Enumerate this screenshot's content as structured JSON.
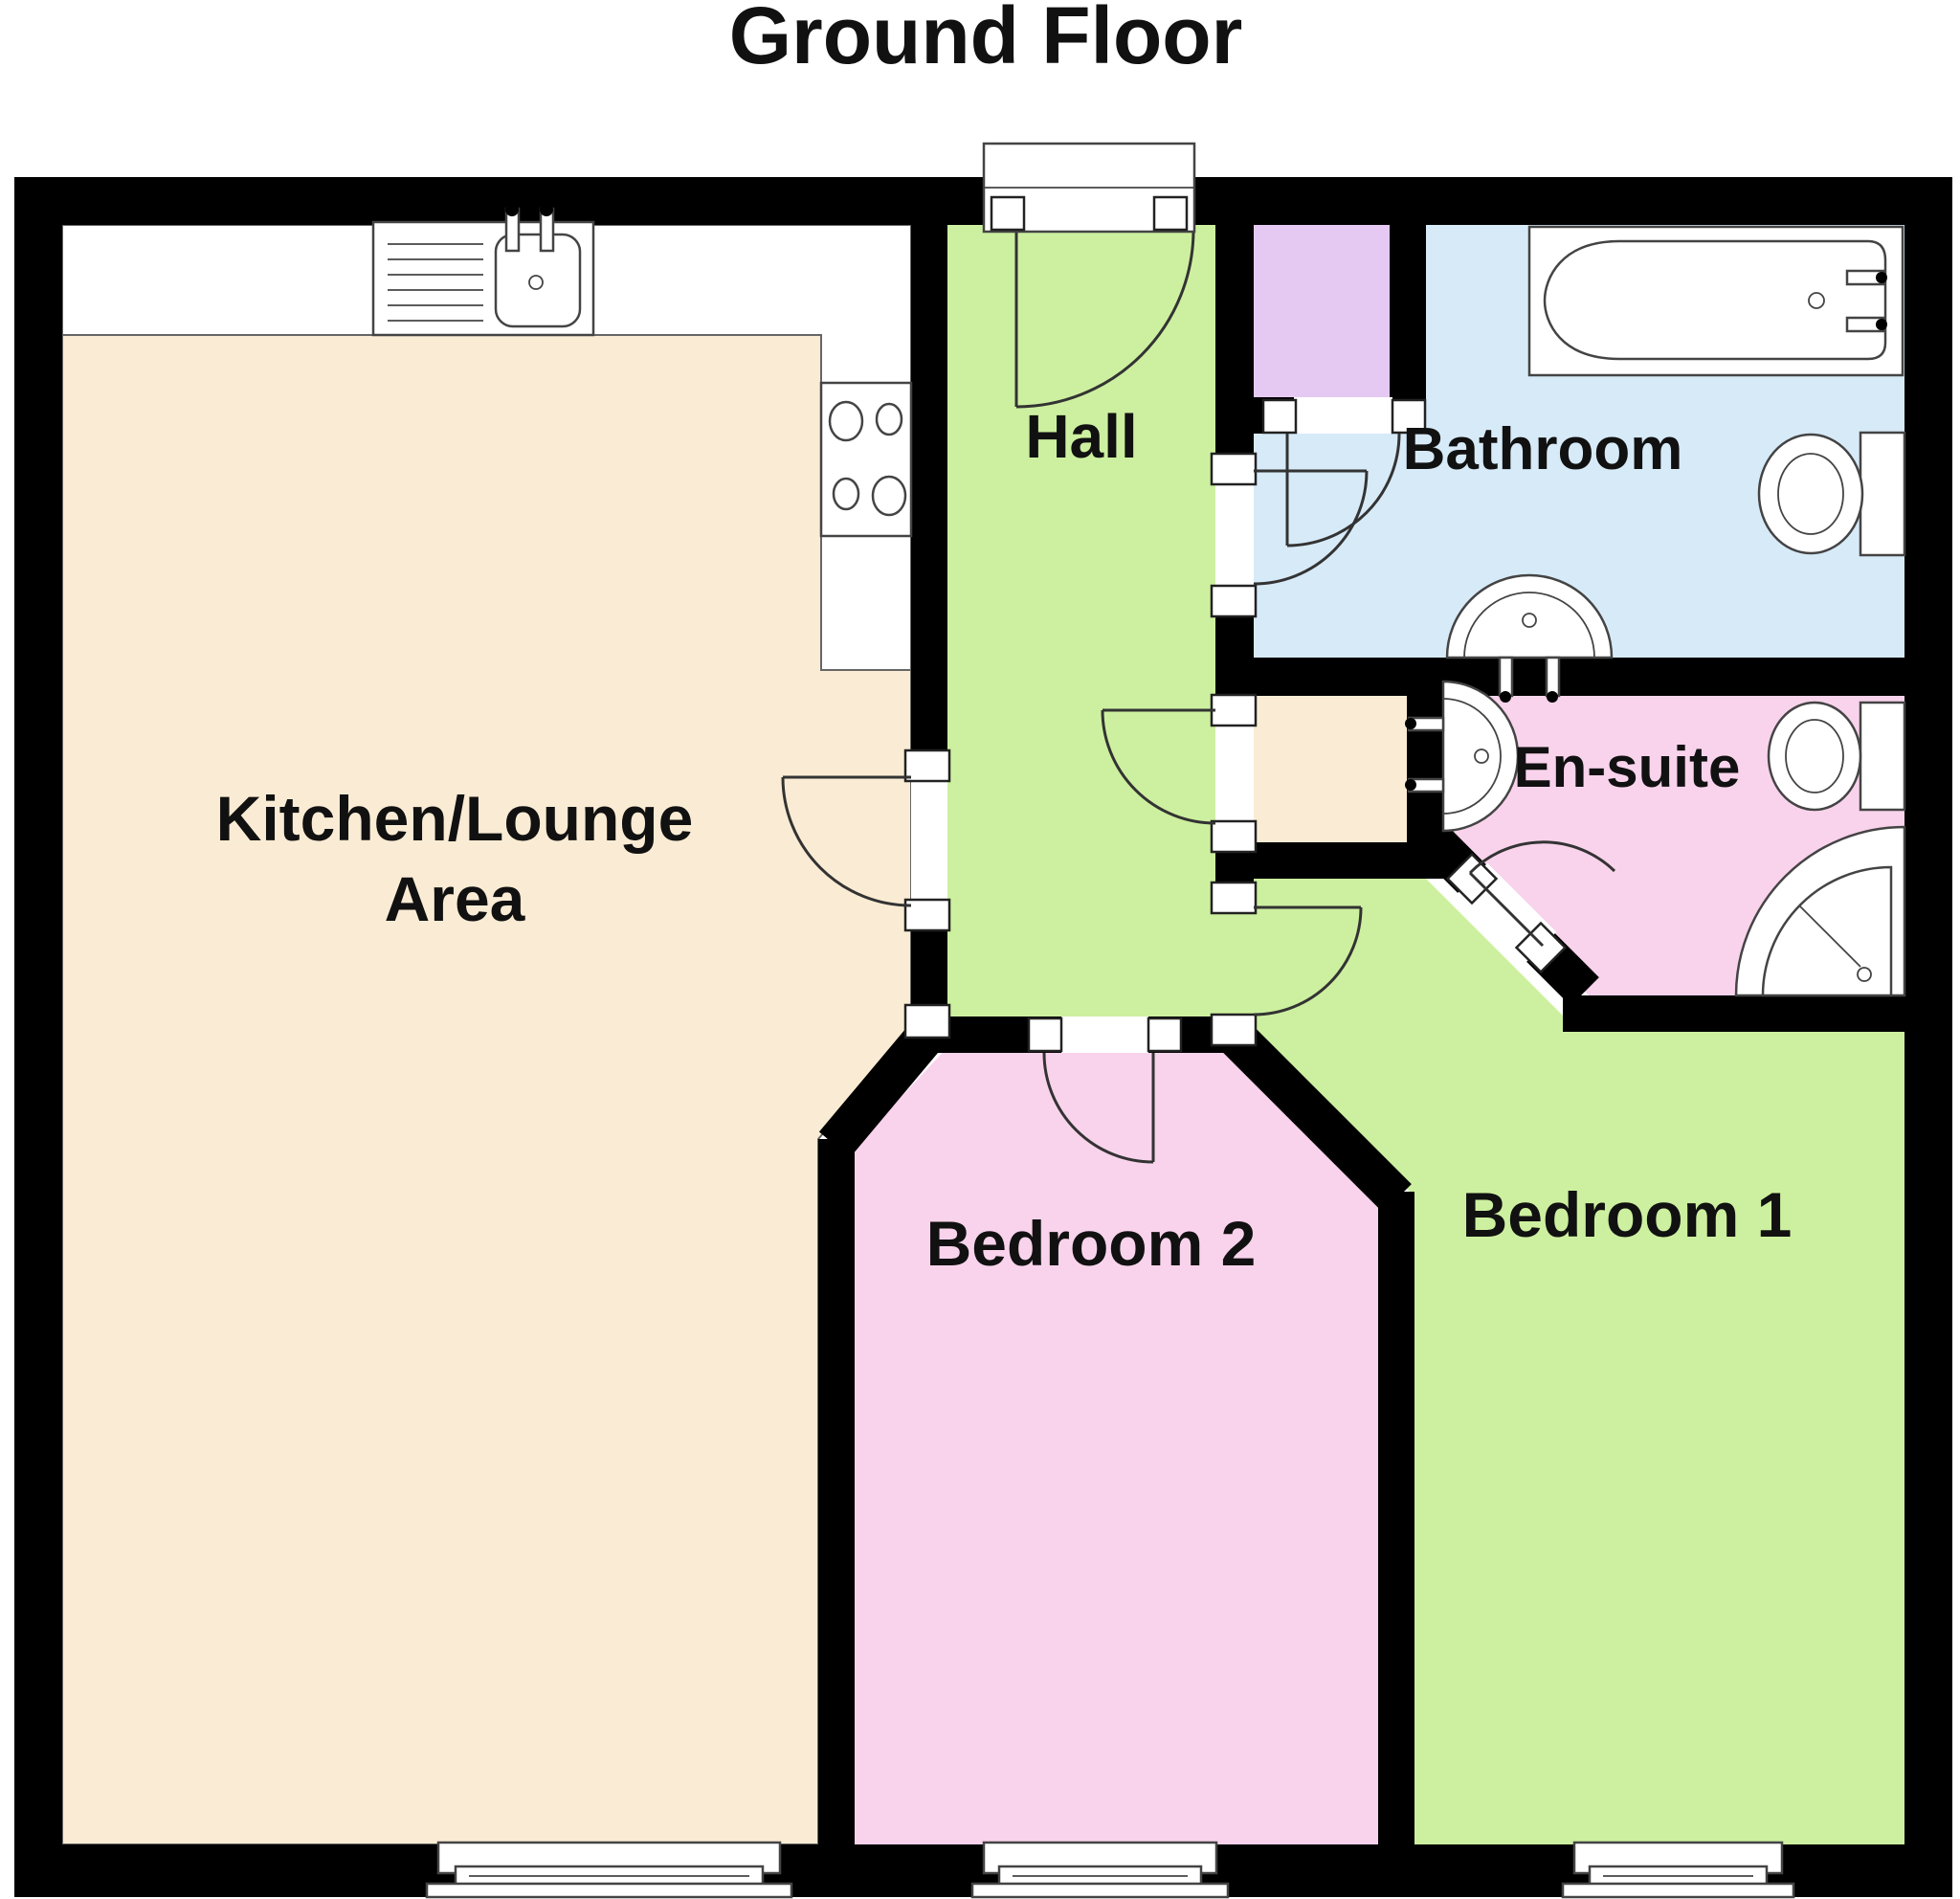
{
  "title": "Ground Floor",
  "rooms": {
    "kitchen": {
      "label_line1": "Kitchen/Lounge",
      "label_line2": "Area"
    },
    "hall": {
      "label": "Hall"
    },
    "bathroom": {
      "label": "Bathroom"
    },
    "ensuite": {
      "label": "En-suite"
    },
    "bedroom2": {
      "label": "Bedroom 2"
    },
    "bedroom1": {
      "label": "Bedroom 1"
    }
  },
  "colors": {
    "wall": "#000000",
    "green": "#cdf0a0",
    "pink": "#f9d3ec",
    "cream": "#faecd4",
    "blue": "#d7eaf8",
    "purple": "#e5c9f2",
    "white": "#ffffff",
    "label": "#111111"
  }
}
